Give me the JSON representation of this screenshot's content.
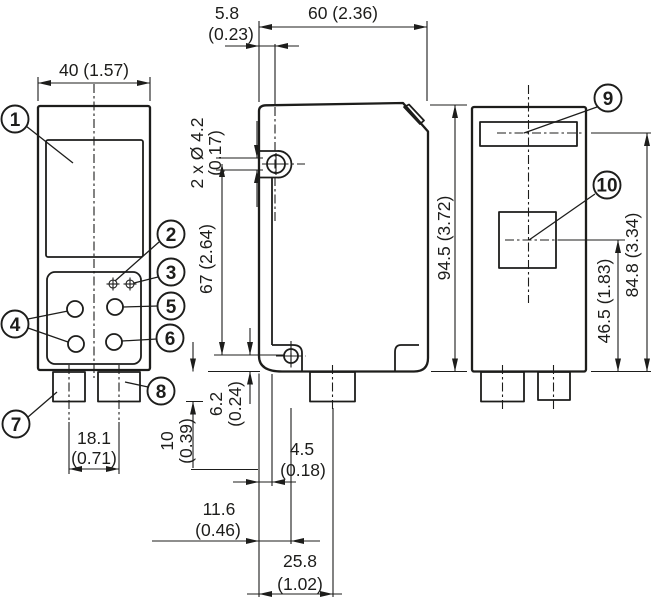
{
  "colors": {
    "line": "#1d1d1b",
    "background": "#ffffff"
  },
  "dimensions": {
    "front_width": {
      "label": "40 (1.57)"
    },
    "hole_axis_offset": {
      "mm": "5.8",
      "inch": "(0.23)"
    },
    "housing_depth": {
      "label": "60 (2.36)"
    },
    "mounting_holes": {
      "mm": "2 x Ø 4.2",
      "inch": "(0.17)"
    },
    "hole_spacing": {
      "label": "67 (2.64)"
    },
    "housing_height": {
      "label": "94.5 (3.72)"
    },
    "indicator_to_bottom": {
      "label": "84.8 (3.34)"
    },
    "window_to_bottom": {
      "label": "46.5 (1.83)"
    },
    "screw_to_bottom": {
      "mm": "6.2",
      "inch": "(0.24)"
    },
    "connector_length": {
      "mm": "10",
      "inch": "(0.39)"
    },
    "connector_spacing": {
      "mm": "18.1",
      "inch": "(0.71)"
    },
    "front_to_lower_edge": {
      "mm": "4.5",
      "inch": "(0.18)"
    },
    "front_to_screw": {
      "mm": "11.6",
      "inch": "(0.46)"
    },
    "front_to_connector": {
      "mm": "25.8",
      "inch": "(1.02)"
    }
  },
  "callouts": {
    "c1": "1",
    "c2": "2",
    "c3": "3",
    "c4": "4",
    "c5": "5",
    "c6": "6",
    "c7": "7",
    "c8": "8",
    "c9": "9",
    "c10": "10"
  }
}
